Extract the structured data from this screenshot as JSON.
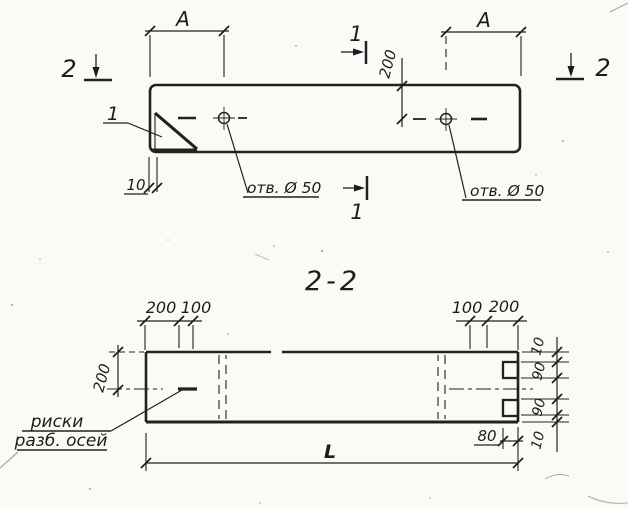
{
  "top_view": {
    "section2_left": "2",
    "section2_right": "2",
    "section1_top": "1",
    "section1_bottom": "1",
    "dim_a_left": "A",
    "dim_a_right": "A",
    "dim_200": "200",
    "dim_10": "10",
    "detail_callout": "1",
    "hole_label_left": "отв. Ø 50",
    "hole_label_right": "отв. Ø 50"
  },
  "section_view": {
    "title": "2-2",
    "dim_top_left": [
      "200",
      "100"
    ],
    "dim_top_right": [
      "100",
      "200"
    ],
    "dim_left": "200",
    "dim_right": [
      "10",
      "90",
      "90",
      "10"
    ],
    "dim_80": "80",
    "dim_length": "L",
    "note_line1": "риски",
    "note_line2": "разб. осей"
  }
}
